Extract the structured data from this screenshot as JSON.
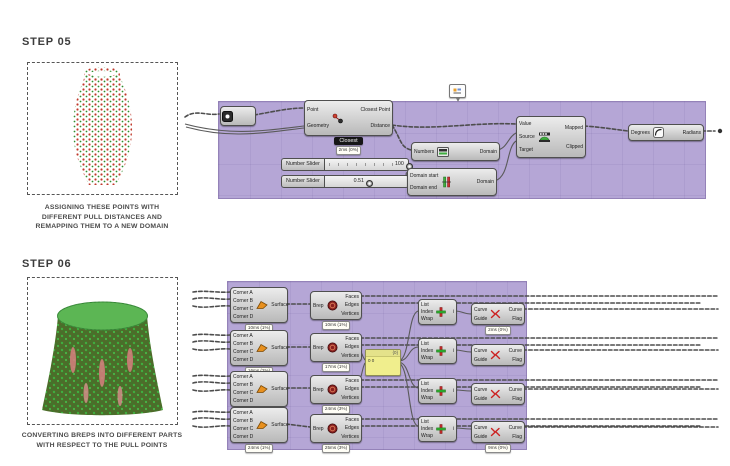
{
  "steps": {
    "step5": {
      "title": "STEP 05",
      "caption_lines": [
        "ASSIGNING THESE POINTS WITH",
        "DIFFERENT PULL DISTANCES AND",
        "REMAPPING THEM TO A NEW DOMAIN"
      ]
    },
    "step6": {
      "title": "STEP 06",
      "caption_lines": [
        "CONVERTING BREPS INTO DIFFERENT PARTS",
        "WITH RESPECT TO THE PULL POINTS"
      ]
    }
  },
  "colors": {
    "group_background": "#b5a6d6",
    "node_face": "#d8d8d8",
    "node_border": "#4f4f4f",
    "wire": "#4d4d4d",
    "panel_yellow": "#f0ee8d",
    "vase_point_red": "#c0392b",
    "vase_point_green": "#2f8f2f",
    "mesh_green": "#54b14c",
    "mesh_body": "#4f6b2a",
    "mesh_pink": "#d77f7f"
  },
  "graph1": {
    "nodes": [
      {
        "id": "point-param",
        "kind": "param",
        "icon": "point-icon",
        "x": 220,
        "y": 106,
        "w": 34,
        "h": 18
      },
      {
        "id": "closest-point-component",
        "kind": "component",
        "icon": "closest-point-icon",
        "x": 304,
        "y": 100,
        "w": 87,
        "h": 34,
        "inputs": [
          "Point",
          "Geometry"
        ],
        "outputs": [
          "Closest Point",
          "Distance"
        ],
        "sub": "Closest",
        "tooltip": "2ms (0%)"
      },
      {
        "id": "number-slider-1",
        "kind": "slider",
        "x": 281,
        "y": 158,
        "w": 128,
        "label": "Number Slider",
        "value": "100",
        "handle_pos": 0.95,
        "ticks": true
      },
      {
        "id": "number-slider-2",
        "kind": "slider",
        "x": 281,
        "y": 175,
        "w": 128,
        "label": "Number Slider",
        "value": "0.51",
        "handle_pos": 0.47,
        "ticks": false
      },
      {
        "id": "bounds-component",
        "kind": "component",
        "icon": "bounds-icon",
        "x": 411,
        "y": 142,
        "w": 87,
        "h": 17,
        "inputs": [
          "Numbers"
        ],
        "outputs": [
          "Domain"
        ]
      },
      {
        "id": "construct-domain-component",
        "kind": "component",
        "icon": "construct-domain-icon",
        "x": 407,
        "y": 168,
        "w": 88,
        "h": 26,
        "inputs": [
          "Domain start",
          "Domain end"
        ],
        "outputs": [
          "Domain"
        ]
      },
      {
        "id": "remap-numbers-component",
        "kind": "component",
        "icon": "remap-icon",
        "x": 516,
        "y": 116,
        "w": 68,
        "h": 40,
        "inputs": [
          "Value",
          "Source",
          "Target"
        ],
        "outputs": [
          "Mapped",
          "Clipped"
        ]
      },
      {
        "id": "degrees-radians-component",
        "kind": "component",
        "icon": "degrees-icon",
        "x": 628,
        "y": 124,
        "w": 74,
        "h": 15,
        "inputs": [
          "Degrees"
        ],
        "outputs": [
          "Radians"
        ]
      },
      {
        "id": "group-tag",
        "kind": "tag",
        "icon": "tag-icon",
        "x": 449,
        "y": 84
      }
    ]
  },
  "graph2": {
    "nodes": [
      {
        "id": "surface-component-1",
        "kind": "component",
        "icon": "surface-icon",
        "x": 230,
        "y": 287,
        "w": 56,
        "h": 34,
        "inputs": [
          "Corner A",
          "Corner B",
          "Corner C",
          "Corner D"
        ],
        "outputs": [
          "Surface"
        ],
        "tooltip": "10ms (1%)"
      },
      {
        "id": "surface-component-2",
        "kind": "component",
        "icon": "surface-icon",
        "x": 230,
        "y": 330,
        "w": 56,
        "h": 34,
        "inputs": [
          "Corner A",
          "Corner B",
          "Corner C",
          "Corner D"
        ],
        "outputs": [
          "Surface"
        ],
        "tooltip": "16ms (2%)"
      },
      {
        "id": "surface-component-3",
        "kind": "component",
        "icon": "surface-icon",
        "x": 230,
        "y": 371,
        "w": 56,
        "h": 34,
        "inputs": [
          "Corner A",
          "Corner B",
          "Corner C",
          "Corner D"
        ],
        "outputs": [
          "Surface"
        ],
        "tooltip": "10ms (1%)"
      },
      {
        "id": "surface-component-4",
        "kind": "component",
        "icon": "surface-icon",
        "x": 230,
        "y": 407,
        "w": 56,
        "h": 34,
        "inputs": [
          "Corner A",
          "Corner B",
          "Corner C",
          "Corner D"
        ],
        "outputs": [
          "Surface"
        ],
        "tooltip": "24ms (1%)"
      },
      {
        "id": "deconstruct-brep-1",
        "kind": "component",
        "icon": "brep-icon",
        "x": 310,
        "y": 291,
        "w": 50,
        "h": 27,
        "inputs": [
          "Brep"
        ],
        "outputs": [
          "Faces",
          "Edges",
          "Vertices"
        ],
        "tooltip": "10ms (1%)"
      },
      {
        "id": "deconstruct-brep-2",
        "kind": "component",
        "icon": "brep-icon",
        "x": 310,
        "y": 333,
        "w": 50,
        "h": 27,
        "inputs": [
          "Brep"
        ],
        "outputs": [
          "Faces",
          "Edges",
          "Vertices"
        ],
        "tooltip": "17ms (1%)"
      },
      {
        "id": "deconstruct-brep-3",
        "kind": "component",
        "icon": "brep-icon",
        "x": 310,
        "y": 375,
        "w": 50,
        "h": 27,
        "inputs": [
          "Brep"
        ],
        "outputs": [
          "Faces",
          "Edges",
          "Vertices"
        ],
        "tooltip": "24ms (3%)"
      },
      {
        "id": "deconstruct-brep-4",
        "kind": "component",
        "icon": "brep-icon",
        "x": 310,
        "y": 414,
        "w": 50,
        "h": 27,
        "inputs": [
          "Brep"
        ],
        "outputs": [
          "Faces",
          "Edges",
          "Vertices"
        ],
        "tooltip": "25ms (3%)"
      },
      {
        "id": "data-panel",
        "kind": "panel",
        "x": 365,
        "y": 349,
        "w": 34,
        "h": 25,
        "head": "{0}",
        "body": "0 0"
      },
      {
        "id": "list-item-1",
        "kind": "component",
        "icon": "list-item-icon",
        "x": 418,
        "y": 299,
        "w": 37,
        "h": 24,
        "inputs": [
          "List",
          "Index",
          "Wrap"
        ],
        "outputs": [
          "i"
        ]
      },
      {
        "id": "list-item-2",
        "kind": "component",
        "icon": "list-item-icon",
        "x": 418,
        "y": 338,
        "w": 37,
        "h": 24,
        "inputs": [
          "List",
          "Index",
          "Wrap"
        ],
        "outputs": [
          "i"
        ]
      },
      {
        "id": "list-item-3",
        "kind": "component",
        "icon": "list-item-icon",
        "x": 418,
        "y": 378,
        "w": 37,
        "h": 24,
        "inputs": [
          "List",
          "Index",
          "Wrap"
        ],
        "outputs": [
          "i"
        ]
      },
      {
        "id": "list-item-4",
        "kind": "component",
        "icon": "list-item-icon",
        "x": 418,
        "y": 416,
        "w": 37,
        "h": 24,
        "inputs": [
          "List",
          "Index",
          "Wrap"
        ],
        "outputs": [
          "i"
        ]
      },
      {
        "id": "flip-curve-1",
        "kind": "component",
        "icon": "flip-icon",
        "x": 471,
        "y": 303,
        "w": 52,
        "h": 20,
        "inputs": [
          "Curve",
          "Guide"
        ],
        "outputs": [
          "Curve",
          "Flag"
        ],
        "tooltip": "2ms (0%)"
      },
      {
        "id": "flip-curve-2",
        "kind": "component",
        "icon": "flip-icon",
        "x": 471,
        "y": 344,
        "w": 52,
        "h": 20,
        "inputs": [
          "Curve",
          "Guide"
        ],
        "outputs": [
          "Curve",
          "Flag"
        ]
      },
      {
        "id": "flip-curve-3",
        "kind": "component",
        "icon": "flip-icon",
        "x": 471,
        "y": 383,
        "w": 52,
        "h": 20,
        "inputs": [
          "Curve",
          "Guide"
        ],
        "outputs": [
          "Curve",
          "Flag"
        ]
      },
      {
        "id": "flip-curve-4",
        "kind": "component",
        "icon": "flip-icon",
        "x": 471,
        "y": 421,
        "w": 52,
        "h": 20,
        "inputs": [
          "Curve",
          "Guide"
        ],
        "outputs": [
          "Curve",
          "Flag"
        ],
        "tooltip": "9ms (0%)"
      }
    ]
  }
}
